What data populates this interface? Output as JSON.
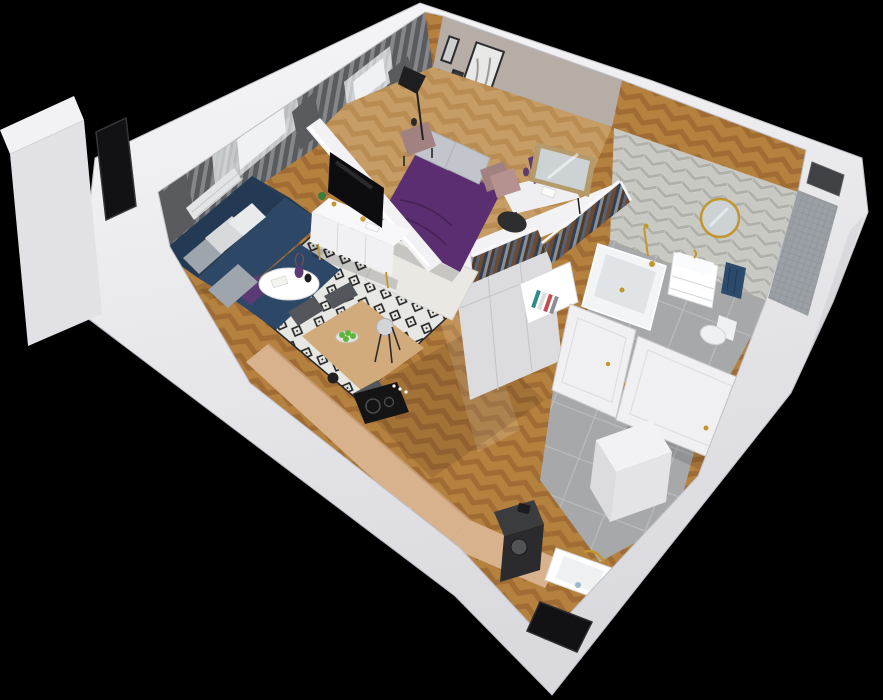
{
  "scene": {
    "kind": "3d-apartment-floorplan-render",
    "view": "isometric-cutaway",
    "width_px": 883,
    "height_px": 700
  },
  "rooms": {
    "living_room": {
      "name": "living-room",
      "items": [
        "corner-sofa",
        "throw-pillows",
        "round-coffee-table",
        "flower-vase",
        "area-rug",
        "tv-console",
        "tv",
        "houseplant",
        "curtains",
        "window",
        "radiator"
      ]
    },
    "bedroom": {
      "name": "bedroom",
      "items": [
        "double-bed",
        "pillows",
        "nightstand",
        "nightstand",
        "floor-lamp",
        "wall-pictures",
        "desk",
        "desk-chair",
        "leaning-mirror",
        "white-rug",
        "window",
        "curtains"
      ]
    },
    "wardrobe": {
      "name": "walk-in-wardrobe",
      "items": [
        "clothes-rail",
        "clothes-rail",
        "base-cabinets",
        "open-bookshelf",
        "open-door"
      ]
    },
    "bathroom": {
      "name": "bathroom",
      "items": [
        "bathtub",
        "shower-fixture",
        "vanity-sink",
        "round-mirror",
        "towel",
        "toilet",
        "chevron-tile-wall",
        "mosaic-tile-wall",
        "vent-recess"
      ]
    },
    "kitchen": {
      "name": "kitchen",
      "items": [
        "l-shaped-counter",
        "induction-cooktop",
        "bar-stools",
        "dining-table",
        "dining-chairs",
        "fruit-bowl",
        "kettle",
        "coffee-machine",
        "sink",
        "window-opening"
      ]
    },
    "hallway": {
      "name": "entry-hall",
      "items": [
        "entrance-door",
        "bathroom-door",
        "storage-box",
        "tile-floor"
      ]
    }
  },
  "palette": {
    "bg": "#000000",
    "wall_top": "#f7f7f9",
    "wall_shade": "#d9d9de",
    "wall_edge": "#bfbfc6",
    "wood_a": "#b5813f",
    "wood_b": "#a06c34",
    "bedwood_a": "#c79d66",
    "bedwood_b": "#b98c52",
    "counter_wood": "#d8b28d",
    "counter_edge": "#c49a73",
    "table_wood": "#d2ab7c",
    "tile_floor": "#a6a8aa",
    "tile_grout": "#b9bbbd",
    "chev_a": "#c9c9c4",
    "chev_b": "#b0b0ab",
    "mosaic": "#9aa0a5",
    "mosaic_grout": "#878c90",
    "greige_wall": "#b6ada7",
    "curtain_dark": "#595b5e",
    "curtain_mid": "#85878a",
    "sheer_a": "#cfd2d5",
    "sheer_b": "#dde0e2",
    "window_bright": "#eff1f2",
    "window_frame": "#3a3c3f",
    "sofa_navy": "#2d4766",
    "sofa_navy_dark": "#243a54",
    "pillow_light": "#d7d9db",
    "pillow_gray": "#9fa5ad",
    "accent_purple": "#5c3a74",
    "rug_base": "#e7e7e4",
    "rug_ink": "#262626",
    "tv_black": "#0d0d0f",
    "console_white": "#f1f1f3",
    "partition_white": "#f2f2f4",
    "bed_purple": "#5a2e70",
    "bed_purple_dark": "#4a2560",
    "bed_pillow": "#c2c5cb",
    "nightstand_mauve": "#a28280",
    "desk_top": "#efeff1",
    "desk_drawer": "#b59190",
    "chair_black": "#2e2e30",
    "chair_gray": "#53565a",
    "stool_seat": "#d3d5d7",
    "mirror_frame": "#b59a6b",
    "mirror_glass": "#cdd2d4",
    "wardrobe_white": "#ededef",
    "cabinet_front": "#dcdcde",
    "tub_white": "#f3f4f6",
    "tub_inner": "#e0e4e7",
    "gold": "#c2962c",
    "towel_navy": "#2c4a6b",
    "toilet_white": "#eef0f1",
    "door_white": "#f0f0f2",
    "door_edge": "#c9c9ce",
    "appliance_dark": "#3a3c3e",
    "stove_black": "#141414",
    "apple_green": "#5fb438",
    "book_teal": "#2e8b8b",
    "book_red": "#c0504d",
    "box_white": "#f2f2f4",
    "vent_dark": "#3f4144",
    "slit_dark": "#121214",
    "radiator": "#e3e4e6",
    "lamp_black": "#1f1f21",
    "clothes_1": "#6e4b2e",
    "clothes_2": "#2f3f58",
    "clothes_3": "#8a8f96",
    "clothes_4": "#4a3b2c",
    "clothes_5": "#56617a"
  }
}
